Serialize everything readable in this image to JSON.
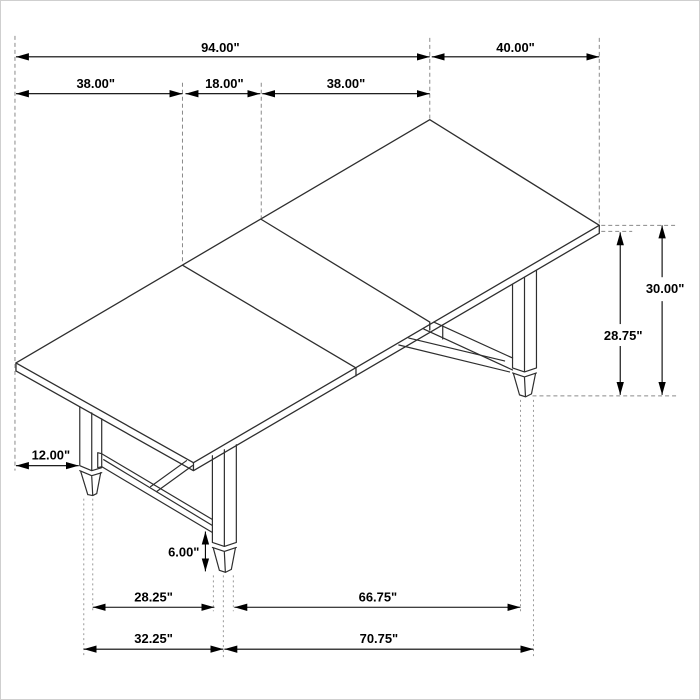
{
  "page": {
    "background": "#ffffff",
    "border_color": "#cfcfcf"
  },
  "drawing": {
    "subject": "extension-dining-table-isometric-dimension-drawing",
    "units": "inches",
    "line_color": "#2e2e2e",
    "dimension_color": "#000000",
    "extension_line_color": "#8a8a8a"
  },
  "dimensions": {
    "overall_length": "94.00\"",
    "overall_width": "40.00\"",
    "left_section": "38.00\"",
    "center_leaf": "18.00\"",
    "right_section": "38.00\"",
    "overall_height": "30.00\"",
    "clearance_height": "28.75\"",
    "leg_inset": "12.00\"",
    "foot_height": "6.00\"",
    "base_gap_inner": "28.25\"",
    "base_span_inner": "66.75\"",
    "base_gap_outer": "32.25\"",
    "base_span_outer": "70.75\""
  }
}
